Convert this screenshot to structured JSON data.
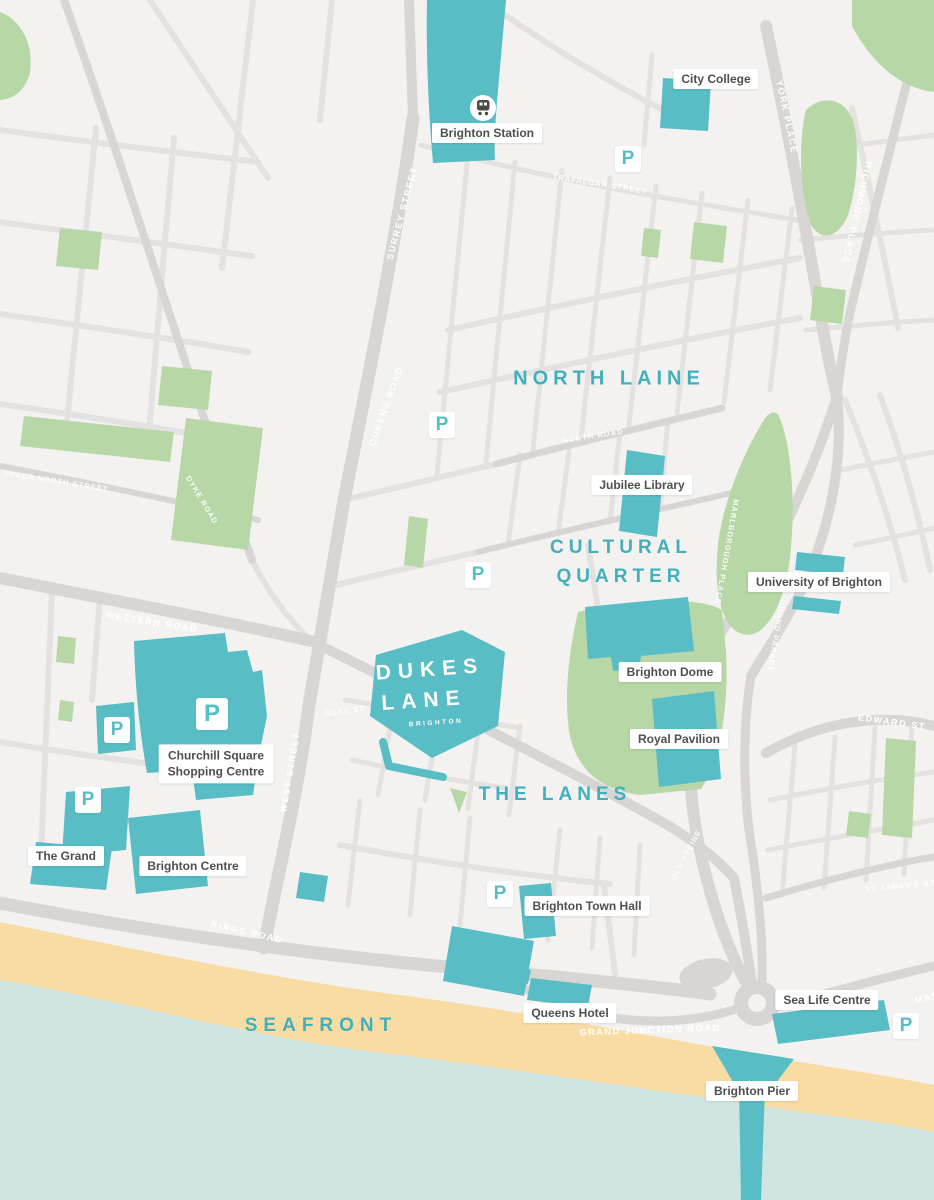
{
  "colors": {
    "land": "#f3f2f0",
    "road-major": "#d7d6d4",
    "road-minor": "#e3e2e0",
    "green": "#b7d7a6",
    "teal": "#58bdc5",
    "teal-text": "#41b0ba",
    "sand": "#f9dca4",
    "sea": "#cfe5e1",
    "ink": "#4f4f4f"
  },
  "areas": {
    "north_laine": "NORTH LAINE",
    "cultural_line1": "CULTURAL",
    "cultural_line2": "QUARTER",
    "the_lanes": "THE LANES",
    "seafront": "SEAFRONT"
  },
  "logo": {
    "line1": "DUKES",
    "line2": "LANE",
    "subtitle": "BRIGHTON"
  },
  "parking": {
    "symbol": "P"
  },
  "landmarks": [
    {
      "label": "City College"
    },
    {
      "label": "Brighton Station"
    },
    {
      "label": "Jubilee Library"
    },
    {
      "label": "University of Brighton"
    },
    {
      "label": "Brighton Dome"
    },
    {
      "label": "Royal Pavilion"
    },
    {
      "line1": "Churchill Square",
      "line2": "Shopping Centre"
    },
    {
      "label": "The Grand"
    },
    {
      "label": "Brighton Centre"
    },
    {
      "label": "Brighton Town Hall"
    },
    {
      "label": "Queens Hotel"
    },
    {
      "label": "Sea Life Centre"
    },
    {
      "label": "Brighton Pier"
    }
  ],
  "streets": [
    {
      "label": "SURREY STREET"
    },
    {
      "label": "QUEENS ROAD"
    },
    {
      "label": "WEST STREET"
    },
    {
      "label": "YORK PLACE"
    },
    {
      "label": "RICHMOND PLACE"
    },
    {
      "label": "WESTERN ROAD"
    },
    {
      "label": "KINGS ROAD"
    },
    {
      "label": "GRAND JUNCTION ROAD"
    },
    {
      "label": "EDWARD ST"
    },
    {
      "label": "MARLBOROUGH PLACE"
    },
    {
      "label": "GRAND PARADE"
    },
    {
      "label": "OLD STEINE"
    },
    {
      "label": "UPPER NORTH STREET"
    },
    {
      "label": "DYKE ROAD"
    },
    {
      "label": "TRAFALGAR STREET"
    },
    {
      "label": "NORTH ROAD"
    },
    {
      "label": "DUKE ST"
    },
    {
      "label": "ST JAMES'S ST"
    },
    {
      "label": "MADEIRA DRIVE"
    }
  ]
}
